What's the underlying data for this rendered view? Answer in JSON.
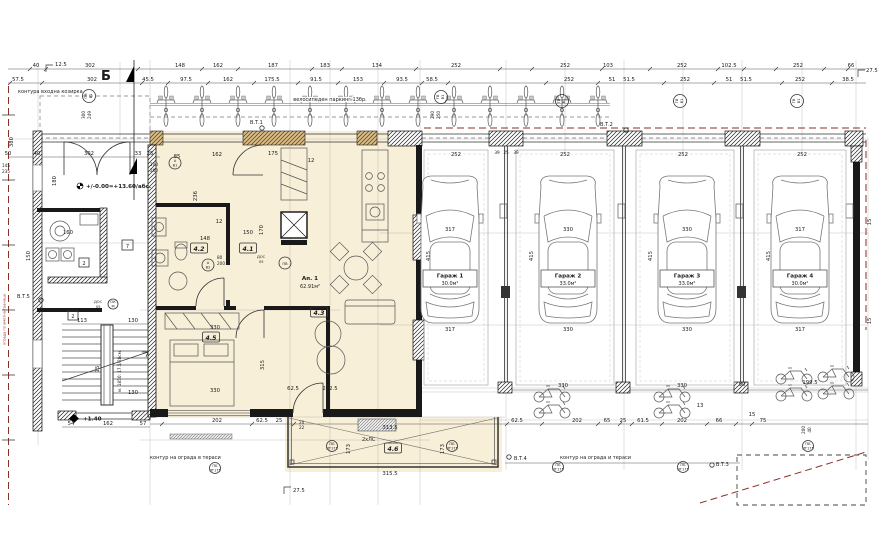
{
  "plan": {
    "axis": {
      "letter": "Б"
    },
    "apartment": {
      "name": "Ап. 1",
      "area": "62.91м²"
    },
    "rooms": {
      "r41": "4.1",
      "r42": "4.2",
      "r43": "4.3",
      "r45": "4.5",
      "r46": "4.6"
    },
    "garages": [
      {
        "name": "Гараж 1",
        "area": "30.0м²"
      },
      {
        "name": "Гараж 2",
        "area": "33.0м²"
      },
      {
        "name": "Гараж 3",
        "area": "33.0м²"
      },
      {
        "name": "Гараж 4",
        "area": "30.0м²"
      }
    ],
    "notes": {
      "canopy": "контура входна козирка",
      "bikes": "велосипеден паркинг 13бр.",
      "fence_left": "контур на ограда в тераси",
      "fence_right": "контур на ограда и тераси",
      "boundary": "ограда по имотна граница",
      "stair_note": "м. 1850: 17.5/28см.",
      "lc": "2хЛС"
    },
    "levels": {
      "abs": "+/-0.00=+13.60/абс.",
      "stair": "+1.40"
    },
    "survey": {
      "vt1": "В.Т.1",
      "vt2": "В.Т.2",
      "vt3": "В.Т.3",
      "vt4": "В.Т.4",
      "vt5": "В.Т.5"
    },
    "tags": {
      "a": "А",
      "b1": "В1",
      "b2": "В2",
      "gv": "ГВ",
      "pv": "ПВ",
      "pb": "ПБ",
      "pt": "ПТ175",
      "dos": "ДОС",
      "dos_n": "05",
      "ok": "ОК",
      "m": "М",
      "two": "2",
      "seven": "7"
    },
    "dims": {
      "topA": [
        "40",
        "302",
        "148",
        "162",
        "187",
        "183",
        "134",
        "252",
        "252",
        "103",
        "252",
        "102.5",
        "252",
        "66"
      ],
      "topB": [
        "57.5",
        "302",
        "45.5",
        "97.5",
        "162",
        "175.5",
        "91.5",
        "153",
        "93.5",
        "58.5",
        "252",
        "51",
        "51.5",
        "252",
        "51",
        "51.5",
        "252",
        "38.5"
      ],
      "corner": [
        "12.5",
        "27.5",
        "27.5"
      ],
      "leftRow": [
        "50",
        "40",
        "302",
        "33",
        "25"
      ],
      "leftV": [
        "380",
        "145",
        "235",
        "180",
        "160",
        "150"
      ],
      "stair": [
        "113",
        "130",
        "130",
        "15",
        "54",
        "162",
        "57"
      ],
      "aptTop": [
        "85",
        "162",
        "175",
        "12"
      ],
      "aptMid": [
        "236",
        "12",
        "150",
        "148",
        "170",
        "100",
        "200",
        "80",
        "200",
        "300",
        "249"
      ],
      "bed": [
        "330",
        "330",
        "315",
        "202",
        "62.5",
        "25"
      ],
      "terr": [
        "313.5",
        "202.5",
        "62.5",
        "173",
        "173",
        "315.5",
        "20",
        "22"
      ],
      "gar": [
        "252",
        "317",
        "317",
        "252",
        "330",
        "330",
        "252",
        "330",
        "330",
        "252",
        "317",
        "317",
        "415",
        "415",
        "415",
        "415",
        "39",
        "25",
        "39",
        "290",
        "250"
      ],
      "bot": [
        "330",
        "90",
        "330",
        "199.5",
        "62.5",
        "202",
        "65",
        "61.5",
        "202",
        "66",
        "75",
        "200",
        "40",
        "15",
        "13",
        "15",
        "15",
        "25"
      ]
    }
  }
}
